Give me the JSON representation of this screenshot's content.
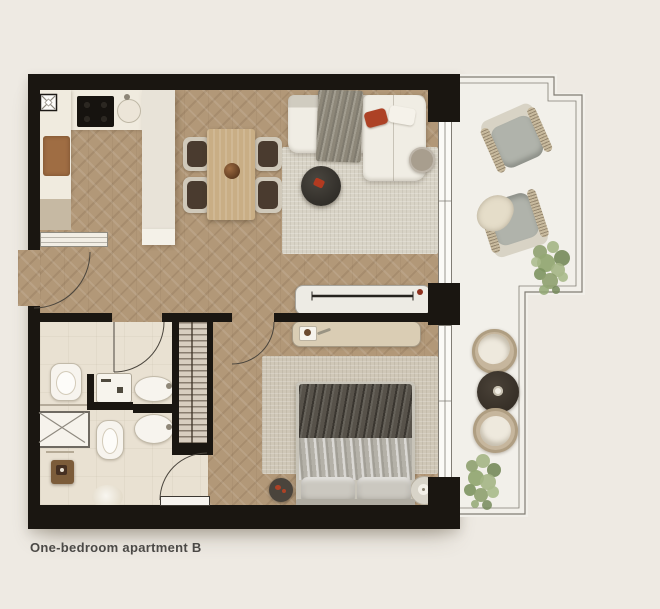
{
  "caption": "One-bedroom apartment B",
  "colors": {
    "page_bg": "#eeeae3",
    "wall": "#1a1611",
    "wood_floor": "#b29878",
    "bath_floor": "#e9e1d2",
    "balcony_floor": "#f2f0ea",
    "outline": "#817d74",
    "counter": "#f0ebdf",
    "island": "#e8e3d8",
    "accent_red": "#ad4226",
    "rug_living": "#d8d3c6",
    "rug_bedroom": "#cfc7b7",
    "sofa": "#f0ede4",
    "table_wood": "#c9ae85",
    "chair_frame": "#d0c9ba",
    "chair_seat": "#4a3b2f",
    "dark_table": "#3b3831",
    "bed_dark": "#57524a",
    "bed_light": "#b4b1a8",
    "pillow": "#cbc8c0",
    "sideboard": "#dacdb4",
    "wardrobe": "#d8cec0",
    "rattan": "#c8ba9e",
    "cushion": "#b0b3ab",
    "greenery": "#8ea06f",
    "fixture": "#f7f4ee",
    "caption_text": "#4b4946"
  },
  "plan": {
    "rooms": [
      "kitchen",
      "living-dining",
      "bedroom",
      "bathroom",
      "shower-room",
      "wardrobe",
      "entrance",
      "balcony"
    ],
    "furniture": [
      "kitchen counter",
      "kitchen island",
      "cooktop",
      "sink",
      "cutting board",
      "dining table",
      "four dining chairs",
      "corner sofa",
      "throw blanket",
      "red pillow",
      "coffee table",
      "side table",
      "living rug",
      "tv console",
      "bedroom sideboard",
      "double bed",
      "bedroom rug",
      "two pillows",
      "nightstand trays",
      "built-in wardrobe",
      "toilet",
      "second toilet",
      "washing machine",
      "two washbasins",
      "shower tray",
      "wooden stool",
      "bath mat",
      "two rattan lounge chairs",
      "two poufs",
      "round outdoor table",
      "two plants"
    ]
  }
}
